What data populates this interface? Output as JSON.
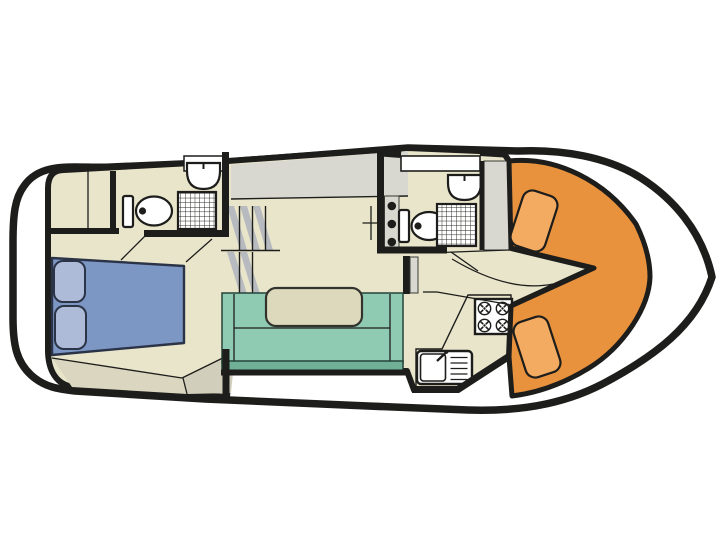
{
  "diagram": {
    "title": "motor-yacht-interior-deck-plan",
    "type": "boat-floor-plan",
    "orientation": {
      "bow": "right",
      "stern": "left"
    },
    "rooms": [
      {
        "name": "aft-cabin-double-berth"
      },
      {
        "name": "aft-bathroom"
      },
      {
        "name": "wardrobe-corner"
      },
      {
        "name": "companionway-stairs"
      },
      {
        "name": "saloon-dinette"
      },
      {
        "name": "galley"
      },
      {
        "name": "fore-bathroom"
      },
      {
        "name": "bow-v-seating"
      }
    ],
    "fixtures": [
      {
        "name": "double-bed"
      },
      {
        "name": "pillow"
      },
      {
        "name": "pillow"
      },
      {
        "name": "toilet"
      },
      {
        "name": "shower"
      },
      {
        "name": "washbasin"
      },
      {
        "name": "toilet"
      },
      {
        "name": "shower"
      },
      {
        "name": "washbasin"
      },
      {
        "name": "dinette-table"
      },
      {
        "name": "bench-sofa"
      },
      {
        "name": "stove-4-burner"
      },
      {
        "name": "galley-sink-with-drainer"
      },
      {
        "name": "seat-cushion"
      },
      {
        "name": "seat-cushion"
      },
      {
        "name": "roof-hatch-window"
      }
    ]
  },
  "colors": {
    "background": "#ffffff",
    "outline": "#1d1d1b",
    "hull_fill": "#ffffff",
    "floor": "#e9e5cb",
    "floor_shadow_1": "#dbd6c0",
    "floor_shadow_2": "#d1cebb",
    "deck_band": "#d8d8d0",
    "stairs": "#b7bbc0",
    "bed": "#7d97c5",
    "pillow": "#aebbd8",
    "sofa": "#8fcbb3",
    "sofa_dark": "#6fb096",
    "table": "#ddd9bd",
    "counter": "#cfcfc6",
    "seat_orange": "#e8923e",
    "cushion_orange": "#f3aa61",
    "fixture": "#ffffff"
  }
}
